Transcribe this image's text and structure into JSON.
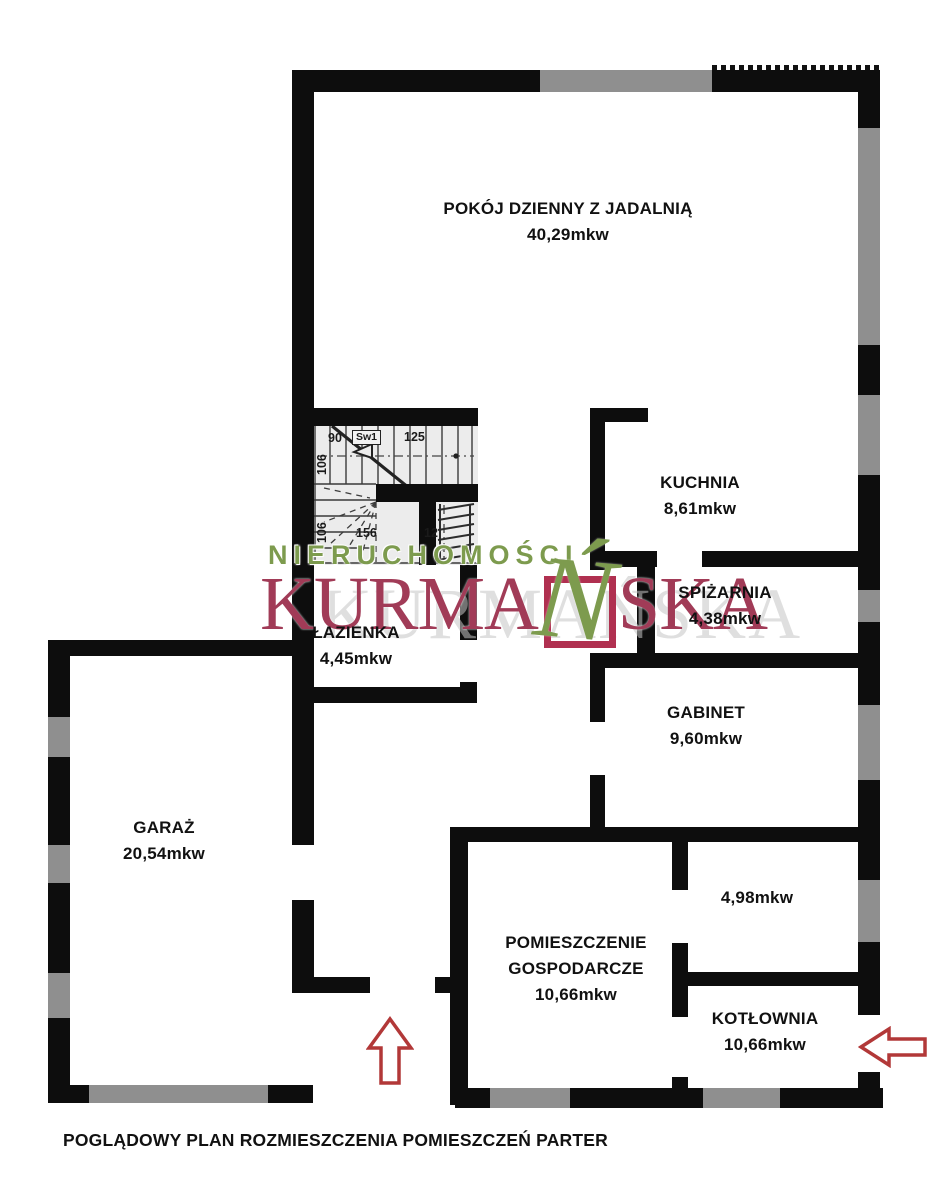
{
  "caption": "POGLĄDOWY PLAN ROZMIESZCZENIA POMIESZCZEŃ PARTER",
  "rooms": [
    {
      "name": "POKÓJ DZIENNY Z JADALNIĄ",
      "area": "40,29mkw"
    },
    {
      "name": "KUCHNIA",
      "area": "8,61mkw"
    },
    {
      "name": "SPIŻARNIA",
      "area": "4,38mkw"
    },
    {
      "name": "ŁAZIENKA",
      "area": "4,45mkw"
    },
    {
      "name": "GABINET",
      "area": "9,60mkw"
    },
    {
      "name": "GARAŻ",
      "area": "20,54mkw"
    },
    {
      "name": "",
      "area": "4,98mkw"
    },
    {
      "name": "POMIESZCZENIE GOSPODARCZE",
      "area": "10,66mkw"
    },
    {
      "name": "KOTŁOWNIA",
      "area": "10,66mkw"
    }
  ],
  "stairs": {
    "s90": "90",
    "sw1": "Sw1",
    "s125": "125",
    "s106a": "106",
    "s106b": "106",
    "s156": "156",
    "s12": "12"
  },
  "watermark": {
    "line1": "NIERUCHOMOŚCI",
    "brand_prefix": "KURMA",
    "brand_n": "Ń",
    "brand_suffix": "SKA",
    "ghost": "KURMAŃSKA"
  },
  "colors": {
    "wall": "#0d0d0d",
    "window_gray": "#8f8f8f",
    "brand_red": "#a13b57",
    "brand_green": "#7d9b4e",
    "arrow_red": "#b23838",
    "stair_bg": "#ececec"
  }
}
